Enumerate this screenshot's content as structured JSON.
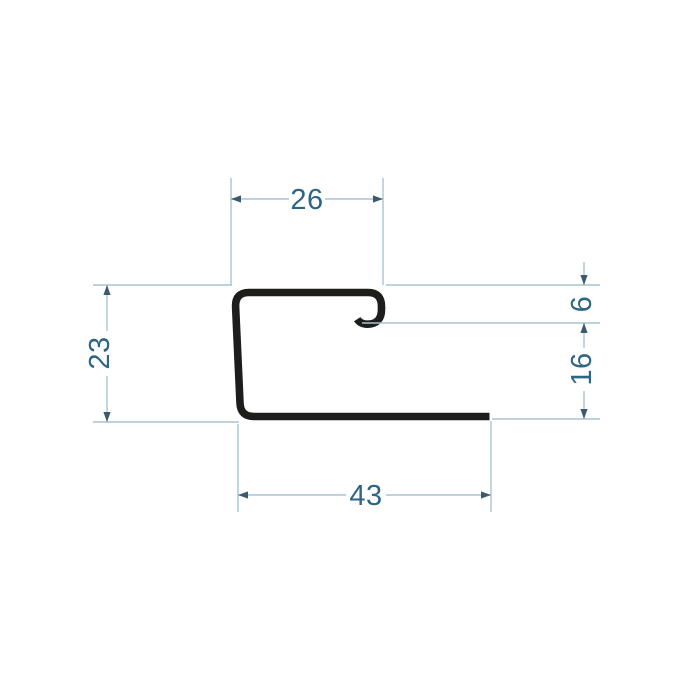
{
  "drawing": {
    "kind": "profile cross-section dimensioned drawing",
    "dimensions": {
      "top_width": "26",
      "left_height": "23",
      "right_hook_depth": "6",
      "right_lower_height": "16",
      "bottom_width": "43"
    },
    "colors": {
      "profile_stroke": "#1d1d1b",
      "dimension_line": "#a7c4d2",
      "dimension_text": "#2e6585",
      "arrowhead": "#3c5a6e"
    }
  }
}
